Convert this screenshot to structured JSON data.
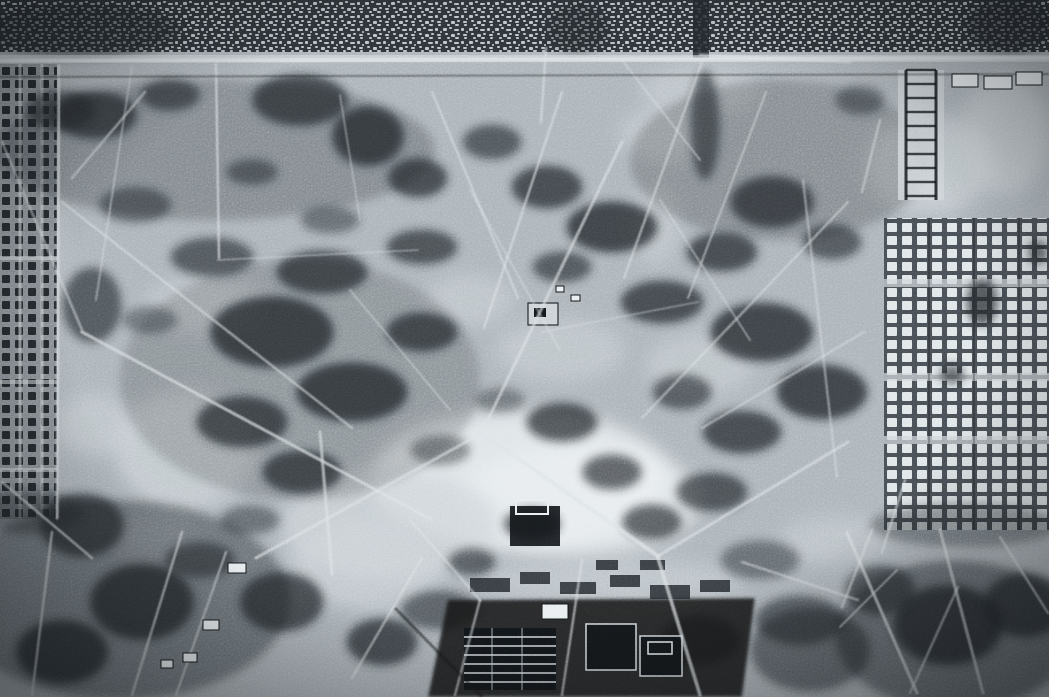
{
  "meta": {
    "aria_label": "Grainy monochrome aerial reconnaissance photograph of a large open park area surrounded by dense city blocks, gridded plots and barracks rows",
    "width": 1049,
    "height": 697
  },
  "photo": {
    "palette": {
      "base": "#a9b1b7",
      "light": "#ccd3d8",
      "bright": "#e8edf0",
      "trail": "#dce2e6",
      "dark": "#22272b",
      "deep": "#121619",
      "urban_bg": "#2d3237",
      "urban_dot": "#b9c0c5",
      "grid_left_bg": "#868d93",
      "grid_left_cell": "#23282c",
      "grid_right_bg": "#454b51",
      "grid_right_cell": "#dfe5e8",
      "vignette": "#0a0d10"
    },
    "regions": [
      {
        "name": "city-blocks-top",
        "bbox": [
          0,
          0,
          1049,
          52
        ]
      },
      {
        "name": "main-road-top",
        "bbox": [
          0,
          52,
          1049,
          24
        ]
      },
      {
        "name": "gridded-plots-left",
        "bbox": [
          0,
          64,
          57,
          455
        ]
      },
      {
        "name": "barracks-grid-right",
        "bbox": [
          884,
          218,
          165,
          312
        ]
      },
      {
        "name": "ladder-building-right-top",
        "bbox": [
          898,
          70,
          46,
          130
        ]
      },
      {
        "name": "open-parkland-center",
        "bbox": [
          60,
          75,
          800,
          520
        ]
      },
      {
        "name": "walled-enclosure-center",
        "bbox": [
          510,
          500,
          50,
          46
        ]
      },
      {
        "name": "building-complex-bottom-center",
        "bbox": [
          430,
          560,
          330,
          137
        ]
      },
      {
        "name": "dark-terrain-bottom-left",
        "bbox": [
          0,
          520,
          430,
          177
        ]
      },
      {
        "name": "dark-terrain-bottom-right",
        "bbox": [
          840,
          525,
          209,
          172
        ]
      }
    ],
    "urban": {
      "strip": [
        0,
        0,
        1049,
        52
      ]
    },
    "grids": {
      "left": {
        "x": 0,
        "y": 64,
        "w": 57,
        "h": 455,
        "alleys_v": [
          20,
          42
        ],
        "alleys_h": [
          258,
          382,
          470
        ]
      },
      "right": {
        "x": 884,
        "y": 218,
        "w": 165,
        "h": 312,
        "alleys_h": [
          283,
          377,
          440
        ],
        "seps_v": [
          929,
          974,
          1019
        ]
      }
    },
    "light_patches": [
      [
        520,
        480,
        150,
        70,
        0.85,
        1
      ],
      [
        580,
        500,
        120,
        55,
        0.8,
        1
      ],
      [
        390,
        525,
        110,
        55,
        0.75,
        0
      ],
      [
        185,
        450,
        70,
        60,
        0.65,
        0
      ],
      [
        205,
        305,
        60,
        28,
        0.55,
        0
      ],
      [
        665,
        135,
        45,
        28,
        0.6,
        0
      ],
      [
        655,
        225,
        25,
        40,
        0.5,
        0
      ],
      [
        700,
        90,
        60,
        25,
        0.5,
        0
      ],
      [
        700,
        365,
        55,
        32,
        0.5,
        0
      ],
      [
        930,
        165,
        65,
        50,
        0.65,
        0
      ],
      [
        1005,
        135,
        45,
        60,
        0.6,
        0
      ],
      [
        365,
        565,
        75,
        45,
        0.6,
        0
      ],
      [
        560,
        350,
        65,
        32,
        0.5,
        0
      ],
      [
        95,
        425,
        40,
        32,
        0.5,
        0
      ],
      [
        470,
        300,
        45,
        26,
        0.5,
        0
      ],
      [
        610,
        580,
        130,
        22,
        0.5,
        0
      ],
      [
        155,
        540,
        40,
        20,
        0.4,
        0
      ],
      [
        835,
        540,
        55,
        25,
        0.45,
        0
      ],
      [
        45,
        250,
        25,
        60,
        0.35,
        0
      ]
    ],
    "dark_patches": [
      [
        215,
        150,
        220,
        70,
        0.3
      ],
      [
        780,
        160,
        150,
        80,
        0.28
      ],
      [
        300,
        380,
        180,
        120,
        0.22
      ],
      [
        120,
        600,
        170,
        100,
        0.45
      ],
      [
        955,
        635,
        120,
        75,
        0.5
      ],
      [
        80,
        30,
        100,
        28,
        0.55
      ],
      [
        1010,
        25,
        45,
        28,
        0.6
      ],
      [
        578,
        28,
        32,
        24,
        0.5
      ],
      [
        95,
        115,
        42,
        24,
        0.75
      ],
      [
        170,
        95,
        30,
        16,
        0.65
      ],
      [
        300,
        100,
        48,
        26,
        0.75
      ],
      [
        368,
        136,
        36,
        30,
        0.8
      ],
      [
        418,
        178,
        30,
        20,
        0.75
      ],
      [
        252,
        172,
        26,
        13,
        0.55
      ],
      [
        135,
        205,
        36,
        18,
        0.55
      ],
      [
        212,
        257,
        42,
        20,
        0.65
      ],
      [
        322,
        272,
        46,
        22,
        0.75
      ],
      [
        422,
        247,
        36,
        18,
        0.7
      ],
      [
        272,
        332,
        62,
        36,
        0.8
      ],
      [
        352,
        392,
        56,
        30,
        0.8
      ],
      [
        242,
        422,
        46,
        26,
        0.75
      ],
      [
        302,
        472,
        40,
        22,
        0.75
      ],
      [
        422,
        332,
        36,
        20,
        0.75
      ],
      [
        492,
        142,
        30,
        18,
        0.65
      ],
      [
        547,
        187,
        36,
        22,
        0.75
      ],
      [
        612,
        227,
        46,
        26,
        0.8
      ],
      [
        562,
        267,
        30,
        16,
        0.65
      ],
      [
        662,
        302,
        42,
        22,
        0.75
      ],
      [
        722,
        252,
        36,
        20,
        0.75
      ],
      [
        772,
        202,
        42,
        26,
        0.75
      ],
      [
        832,
        242,
        30,
        18,
        0.65
      ],
      [
        762,
        332,
        52,
        30,
        0.8
      ],
      [
        822,
        392,
        46,
        28,
        0.8
      ],
      [
        742,
        432,
        40,
        22,
        0.75
      ],
      [
        682,
        392,
        30,
        18,
        0.65
      ],
      [
        562,
        422,
        36,
        20,
        0.75
      ],
      [
        612,
        472,
        30,
        18,
        0.7
      ],
      [
        532,
        524,
        28,
        16,
        0.75
      ],
      [
        472,
        562,
        24,
        14,
        0.65
      ],
      [
        652,
        522,
        30,
        18,
        0.7
      ],
      [
        712,
        492,
        36,
        20,
        0.7
      ],
      [
        92,
        305,
        30,
        38,
        0.65
      ],
      [
        82,
        525,
        42,
        32,
        0.75
      ],
      [
        142,
        602,
        52,
        38,
        0.8
      ],
      [
        62,
        652,
        46,
        32,
        0.8
      ],
      [
        282,
        602,
        42,
        30,
        0.75
      ],
      [
        382,
        642,
        36,
        24,
        0.75
      ],
      [
        705,
        125,
        15,
        55,
        0.65
      ],
      [
        982,
        302,
        16,
        24,
        0.75
      ],
      [
        952,
        374,
        12,
        10,
        0.65
      ],
      [
        1038,
        252,
        10,
        12,
        0.65
      ],
      [
        948,
        625,
        55,
        40,
        0.8
      ],
      [
        1025,
        605,
        42,
        32,
        0.75
      ],
      [
        880,
        590,
        35,
        25,
        0.65
      ],
      [
        60,
        110,
        35,
        20,
        0.6
      ],
      [
        440,
        450,
        30,
        15,
        0.5
      ],
      [
        500,
        400,
        25,
        12,
        0.45
      ],
      [
        330,
        220,
        30,
        14,
        0.5
      ],
      [
        150,
        320,
        28,
        14,
        0.45
      ],
      [
        250,
        520,
        30,
        15,
        0.5
      ],
      [
        200,
        560,
        35,
        18,
        0.6
      ],
      [
        440,
        610,
        40,
        20,
        0.6
      ],
      [
        760,
        560,
        40,
        20,
        0.5
      ],
      [
        800,
        620,
        45,
        25,
        0.6
      ],
      [
        700,
        640,
        40,
        25,
        0.6
      ],
      [
        860,
        100,
        25,
        15,
        0.5
      ],
      [
        965,
        525,
        95,
        22,
        0.4
      ],
      [
        28,
        512,
        55,
        22,
        0.45
      ],
      [
        810,
        650,
        60,
        42,
        0.55
      ]
    ],
    "trails": [
      [
        0,
        60,
        1049,
        57,
        12,
        0.5
      ],
      [
        0,
        61,
        1049,
        58,
        4,
        0.8
      ],
      [
        59,
        66,
        57,
        518,
        3,
        0.65
      ],
      [
        546,
        48,
        541,
        122,
        2.5,
        0.55
      ],
      [
        216,
        64,
        219,
        258,
        2.5,
        0.6
      ],
      [
        82,
        332,
        432,
        520,
        3,
        0.65
      ],
      [
        62,
        202,
        352,
        428,
        2.5,
        0.5
      ],
      [
        432,
        92,
        518,
        298,
        2.5,
        0.5
      ],
      [
        562,
        92,
        484,
        328,
        2.5,
        0.55
      ],
      [
        622,
        142,
        484,
        428,
        3,
        0.6
      ],
      [
        702,
        62,
        624,
        278,
        2.5,
        0.5
      ],
      [
        766,
        92,
        688,
        298,
        2.2,
        0.45
      ],
      [
        484,
        432,
        256,
        558,
        3,
        0.6
      ],
      [
        480,
        432,
        658,
        556,
        4,
        0.7
      ],
      [
        658,
        556,
        848,
        442,
        3,
        0.6
      ],
      [
        658,
        558,
        700,
        695,
        3.5,
        0.65
      ],
      [
        582,
        560,
        562,
        695,
        2.5,
        0.55
      ],
      [
        422,
        558,
        352,
        678,
        2.5,
        0.5
      ],
      [
        848,
        202,
        642,
        418,
        2.5,
        0.45
      ],
      [
        864,
        332,
        702,
        428,
        2.2,
        0.45
      ],
      [
        803,
        180,
        837,
        477,
        2.5,
        0.4
      ],
      [
        2,
        482,
        92,
        558,
        2.5,
        0.55
      ],
      [
        52,
        532,
        32,
        695,
        2.5,
        0.55
      ],
      [
        182,
        532,
        132,
        695,
        2.5,
        0.55
      ],
      [
        226,
        552,
        176,
        695,
        2.2,
        0.5
      ],
      [
        320,
        432,
        332,
        574,
        3,
        0.6
      ],
      [
        2,
        142,
        82,
        330,
        2.5,
        0.45
      ],
      [
        145,
        92,
        72,
        178,
        2.5,
        0.5
      ],
      [
        132,
        66,
        96,
        300,
        2,
        0.4
      ],
      [
        742,
        562,
        858,
        600,
        2.5,
        0.45
      ],
      [
        542,
        332,
        698,
        302,
        1.8,
        0.35
      ],
      [
        218,
        260,
        418,
        250,
        1.8,
        0.35
      ],
      [
        470,
        190,
        560,
        350,
        2,
        0.4
      ],
      [
        660,
        200,
        750,
        340,
        2,
        0.4
      ],
      [
        350,
        290,
        450,
        410,
        2,
        0.4
      ],
      [
        880,
        120,
        862,
        192,
        2.5,
        0.45
      ],
      [
        700,
        55,
        850,
        62,
        3,
        0.45
      ],
      [
        847,
        533,
        917,
        693,
        3,
        0.6
      ],
      [
        872,
        530,
        842,
        607,
        2.5,
        0.5
      ],
      [
        940,
        530,
        983,
        693,
        3,
        0.55
      ],
      [
        1000,
        537,
        1048,
        613,
        2.5,
        0.5
      ],
      [
        897,
        570,
        840,
        627,
        2,
        0.45
      ],
      [
        958,
        587,
        910,
        693,
        2.5,
        0.45
      ],
      [
        410,
        520,
        480,
        600,
        2.5,
        0.45
      ],
      [
        480,
        600,
        455,
        695,
        2.5,
        0.5
      ],
      [
        340,
        95,
        360,
        220,
        2,
        0.35
      ],
      [
        905,
        480,
        882,
        552,
        2.5,
        0.5
      ],
      [
        622,
        60,
        700,
        160,
        2.2,
        0.4
      ]
    ],
    "dark_lines": [
      [
        0,
        77,
        1049,
        74,
        2,
        0.45
      ],
      [
        395,
        608,
        482,
        697,
        3,
        0.55
      ],
      [
        884,
        220,
        884,
        532,
        2,
        0.35
      ]
    ],
    "structures": {
      "ladder": {
        "x": 898,
        "y": 70,
        "w": 46,
        "h": 130,
        "rails": [
          8,
          38
        ],
        "rung_gap": 14
      },
      "white_blocks": [
        [
          952,
          74,
          26,
          13
        ],
        [
          984,
          76,
          28,
          13
        ],
        [
          1016,
          72,
          26,
          13
        ],
        [
          542,
          604,
          26,
          15
        ],
        [
          228,
          563,
          18,
          10
        ],
        [
          203,
          620,
          16,
          10
        ],
        [
          183,
          653,
          14,
          9
        ],
        [
          161,
          660,
          12,
          8
        ],
        [
          556,
          286,
          8,
          6
        ],
        [
          571,
          295,
          9,
          6
        ]
      ],
      "outlined_blocks": [
        [
          528,
          303,
          30,
          22,
          1
        ],
        [
          586,
          624,
          50,
          46,
          0
        ],
        [
          640,
          636,
          42,
          40,
          0
        ]
      ],
      "inner_marks": [
        [
          534,
          308,
          12,
          9,
          "d"
        ],
        [
          648,
          642,
          24,
          12,
          "o"
        ]
      ],
      "walled_enclosure": {
        "rect": [
          510,
          506,
          50,
          40
        ],
        "wall": [
          516,
          500,
          32,
          14
        ]
      },
      "striped_block": {
        "x": 464,
        "y": 628,
        "w": 92,
        "h": 62,
        "gap": 9
      },
      "dark_blocks": [
        [
          470,
          578,
          40,
          14
        ],
        [
          520,
          572,
          30,
          12
        ],
        [
          560,
          582,
          36,
          12
        ],
        [
          610,
          575,
          30,
          12
        ],
        [
          650,
          585,
          40,
          14
        ],
        [
          700,
          580,
          30,
          12
        ],
        [
          596,
          560,
          22,
          10
        ],
        [
          640,
          560,
          25,
          10
        ],
        [
          693,
          0,
          16,
          58
        ]
      ],
      "complex_base": [
        [
          448,
          600
        ],
        [
          755,
          598
        ],
        [
          742,
          697
        ],
        [
          428,
          697
        ]
      ]
    }
  }
}
